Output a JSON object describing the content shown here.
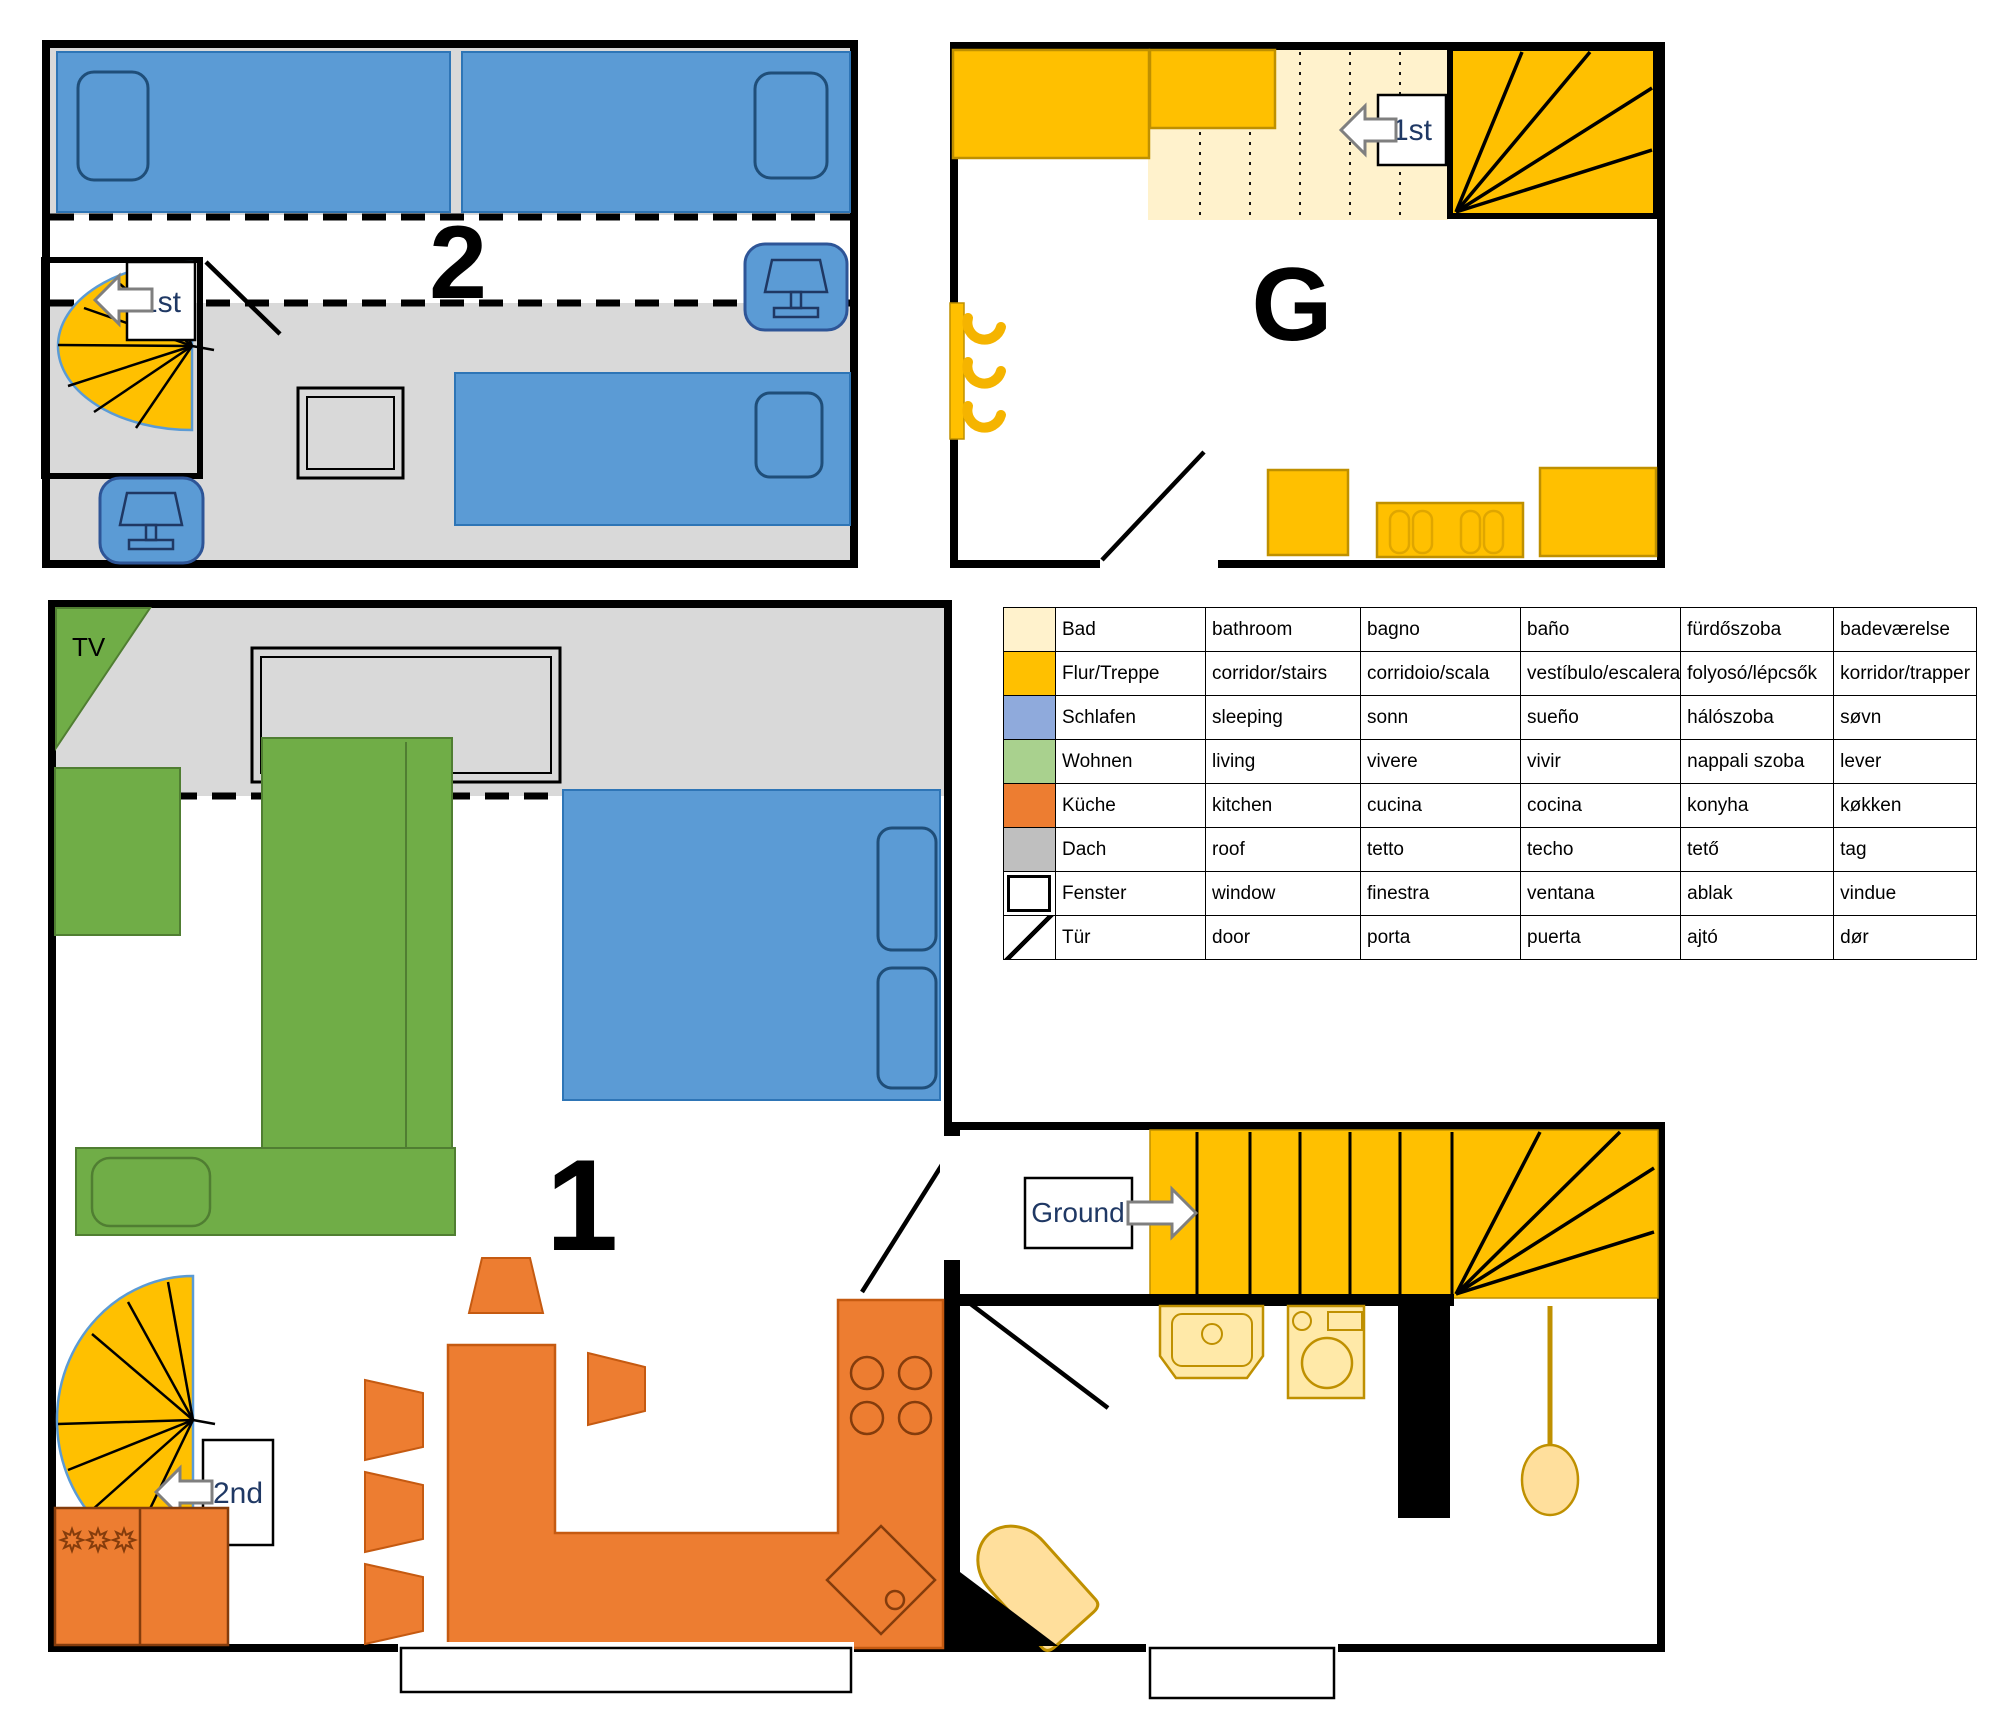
{
  "plans": {
    "floor2": {
      "label": "2",
      "stair_label": "1st"
    },
    "floorG": {
      "label": "G",
      "stair_label": "1st"
    },
    "floor1": {
      "label": "1",
      "stair_label": "2nd",
      "tv_label": "TV"
    },
    "ground": {
      "stair_label": "Ground"
    }
  },
  "legend": {
    "rows": [
      {
        "name": "bathroom",
        "color": "#FFF2CC",
        "swatch": "color",
        "cells": [
          "Bad",
          "bathroom",
          "bagno",
          "baño",
          "fürdőszoba",
          "badeværelse"
        ]
      },
      {
        "name": "corridor-stairs",
        "color": "#FFC000",
        "swatch": "color",
        "cells": [
          "Flur/Treppe",
          "corridor/stairs",
          "corridoio/scala",
          "vestíbulo/escalera",
          "folyosó/lépcsők",
          "korridor/trapper"
        ]
      },
      {
        "name": "sleeping",
        "color": "#8FAADC",
        "swatch": "color",
        "cells": [
          "Schlafen",
          "sleeping",
          "sonn",
          "sueño",
          "hálószoba",
          "søvn"
        ]
      },
      {
        "name": "living",
        "color": "#A9D18E",
        "swatch": "color",
        "cells": [
          "Wohnen",
          "living",
          "vivere",
          "vivir",
          "nappali szoba",
          "lever"
        ]
      },
      {
        "name": "kitchen",
        "color": "#ED7D31",
        "swatch": "color",
        "cells": [
          "Küche",
          "kitchen",
          "cucina",
          "cocina",
          "konyha",
          "køkken"
        ]
      },
      {
        "name": "roof",
        "color": "#BFBFBF",
        "swatch": "color",
        "cells": [
          "Dach",
          "roof",
          "tetto",
          "techo",
          "tető",
          "tag"
        ]
      },
      {
        "name": "window",
        "color": "#FFFFFF",
        "swatch": "window",
        "cells": [
          "Fenster",
          "window",
          "finestra",
          "ventana",
          "ablak",
          "vindue"
        ]
      },
      {
        "name": "door",
        "color": "#FFFFFF",
        "swatch": "door",
        "cells": [
          "Tür",
          "door",
          "porta",
          "puerta",
          "ajtó",
          "dør"
        ]
      }
    ]
  },
  "colors": {
    "bed_blue": "#5B9BD5",
    "living_green": "#70AD47",
    "kitchen_orange": "#ED7D31",
    "stairs_yellow": "#FFC000",
    "bath_cream": "#FFF2CC",
    "roof_gray": "#D9D9D9",
    "fixture_cream": "#FFE9A8",
    "label_navy": "#1F3864"
  }
}
